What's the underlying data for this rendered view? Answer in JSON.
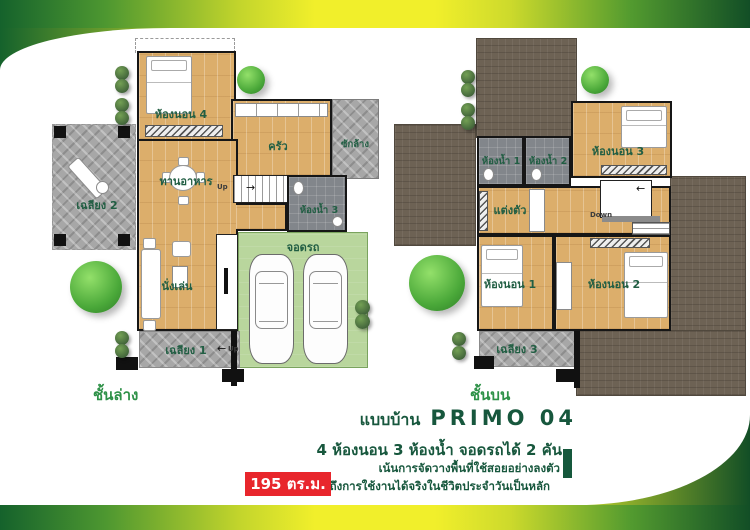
{
  "info": {
    "title_prefix": "แบบบ้าน",
    "model": "PRIMO 04",
    "specs": "4 ห้องนอน 3 ห้องน้ำ จอดรถได้ 2 คัน",
    "tagline1": "เน้นการจัดวางพื้นที่ใช้สอยอย่างลงตัว",
    "tagline2": "คำนึงถึงการใช้งานได้จริงในชีวิตประจำวันเป็นหลัก",
    "area": "195 ตร.ม."
  },
  "floors": {
    "ground": {
      "label": "ชั้นล่าง",
      "rooms": {
        "bedroom4": "ห้องนอน 4",
        "kitchen": "ครัว",
        "laundry": "ซักล้าง",
        "dining": "ทานอาหาร",
        "porch2": "เฉลียง 2",
        "bath3": "ห้องน้ำ 3",
        "living": "นั่งเล่น",
        "parking": "จอดรถ",
        "porch1": "เฉลียง 1",
        "stairs_up": "Up",
        "porch_up": "Up"
      }
    },
    "upper": {
      "label": "ชั้นบน",
      "rooms": {
        "bath1": "ห้องน้ำ 1",
        "bath2": "ห้องน้ำ 2",
        "bedroom3": "ห้องนอน 3",
        "dressing": "แต่งตัว",
        "bedroom1": "ห้องนอน 1",
        "bedroom2": "ห้องนอน 2",
        "porch3": "เฉลียง 3",
        "stairs_down": "Down"
      }
    }
  },
  "icons": {
    "arrow_left": "←",
    "arrow_right": "→"
  },
  "colors": {
    "accent_green_dark": "#14532a",
    "accent_yellow": "#f1ef2b",
    "badge_red": "#e8262c",
    "wood_floor": "#dcae6b",
    "parking_green": "#b9d69d",
    "roof_brown": "#6d6254",
    "porch_gray": "#a7a7a7",
    "bath_gray": "#82868b",
    "text_green": "#17573d",
    "floor_label_green": "#2e9148"
  }
}
